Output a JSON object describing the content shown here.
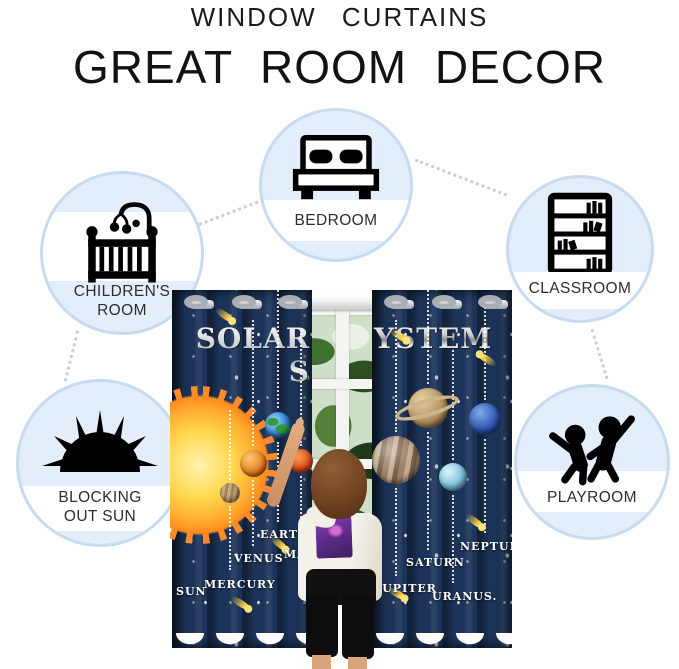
{
  "header": {
    "subtitle": "WINDOW CURTAINS",
    "title": "GREAT ROOM DECOR"
  },
  "bubbles": {
    "bedroom": {
      "label": "BEDROOM",
      "icon": "bed-icon"
    },
    "classroom": {
      "label": "CLASSROOM",
      "icon": "bookshelf-icon"
    },
    "childrens_room": {
      "line1": "CHILDREN'S",
      "line2": "ROOM",
      "icon": "crib-icon"
    },
    "blocking_sun": {
      "line1": "BLOCKING",
      "line2": "OUT SUN",
      "icon": "sun-icon"
    },
    "playroom": {
      "label": "PLAYROOM",
      "icon": "playing-kids-icon"
    }
  },
  "curtain": {
    "title_left": "SOLAR S",
    "title_right": "YSTEM",
    "planet_labels": {
      "sun": "SUN",
      "mercury": "MERCURY",
      "venus": "VENUS",
      "earth": "EARTH",
      "mars": "MARS",
      "jupiter": "JUPITER",
      "saturn": "SATURN",
      "uranus": "URANUS.",
      "neptune": "NEPTUN"
    }
  },
  "colors": {
    "bubble_fill": "#e4eefb",
    "bubble_border": "#c6daf0",
    "curtain_navy": "#1c3459",
    "connector_dots": "#c9ced4",
    "sun_orange": "#ff8a1f",
    "headline_silver": "#c9ccd2"
  }
}
